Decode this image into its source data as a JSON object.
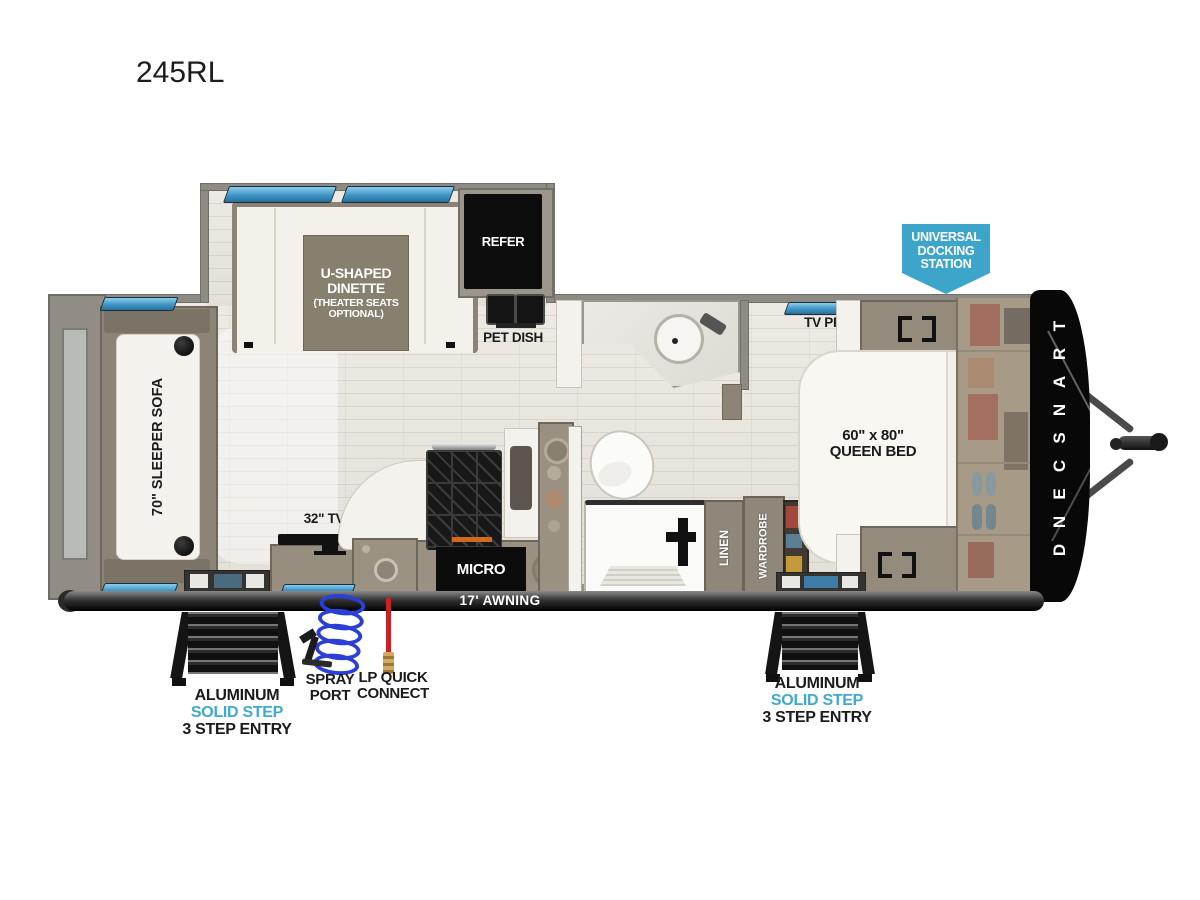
{
  "title": "245RL",
  "badge": {
    "lines": [
      "UNIVERSAL",
      "DOCKING",
      "STATION"
    ]
  },
  "interior": {
    "dinette": {
      "lines": [
        "U-SHAPED",
        "DINETTE",
        "(THEATER SEATS",
        "OPTIONAL)"
      ]
    },
    "refer": "REFER",
    "pet_dish": "PET DISH",
    "sleeper_sofa": "70\" SLEEPER SOFA",
    "tv": "32\" TV",
    "micro": "MICRO",
    "linen": "LINEN",
    "wardrobe": "WARDROBE",
    "tv_prep": "TV PREP",
    "queen_bed": {
      "lines": [
        "60\" x 80\"",
        "QUEEN BED"
      ]
    },
    "brand": "TRANSCEND"
  },
  "exterior": {
    "awning": "17' AWNING",
    "spray_port": {
      "lines": [
        "SPRAY",
        "PORT"
      ]
    },
    "lp_quick_connect": {
      "lines": [
        "LP QUICK",
        "CONNECT"
      ]
    },
    "entry_step_left": {
      "lines": [
        "ALUMINUM",
        "SOLID STEP",
        "3 STEP ENTRY"
      ]
    },
    "entry_step_right": {
      "lines": [
        "ALUMINUM",
        "SOLID STEP",
        "3 STEP ENTRY"
      ]
    }
  },
  "colors": {
    "accent_blue": "#3FA9CE",
    "window_blue": "#3E9FD4",
    "lp_red": "#C92222",
    "coil_blue": "#2B3FD6"
  }
}
